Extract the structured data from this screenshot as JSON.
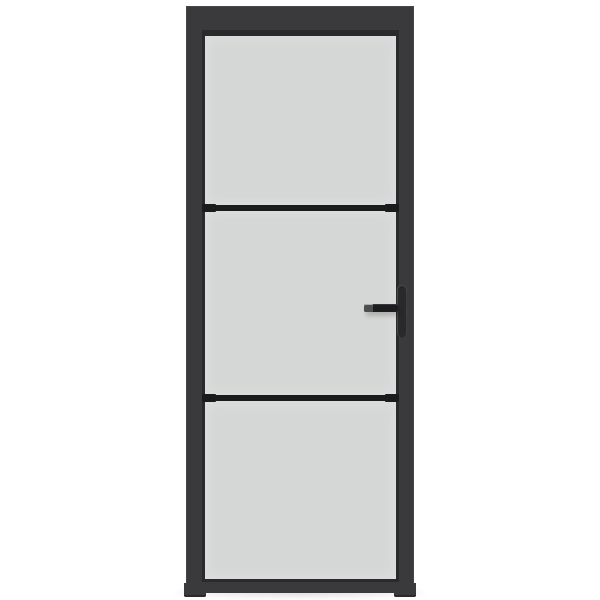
{
  "image": {
    "description": "Product photo of an interior door with a black metal frame, three frosted glass panels separated by two slim black glazing bars, and a black lever handle with vertical backplate on the right stile, shown on a plain white background",
    "panel_count": 3,
    "handle_side": "right"
  },
  "colors": {
    "background": "#ffffff",
    "frame": "#3a3a3c",
    "frame_highlight": "#47474a",
    "frame_dark": "#2a2a2c",
    "glass": "#d5d7d6",
    "glass_edge": "#e0e2e1",
    "divider": "#1b1b1d",
    "handle": "#1d1d1f",
    "handle_plate": "#29292b",
    "handle_tip": "#4e4e50"
  }
}
